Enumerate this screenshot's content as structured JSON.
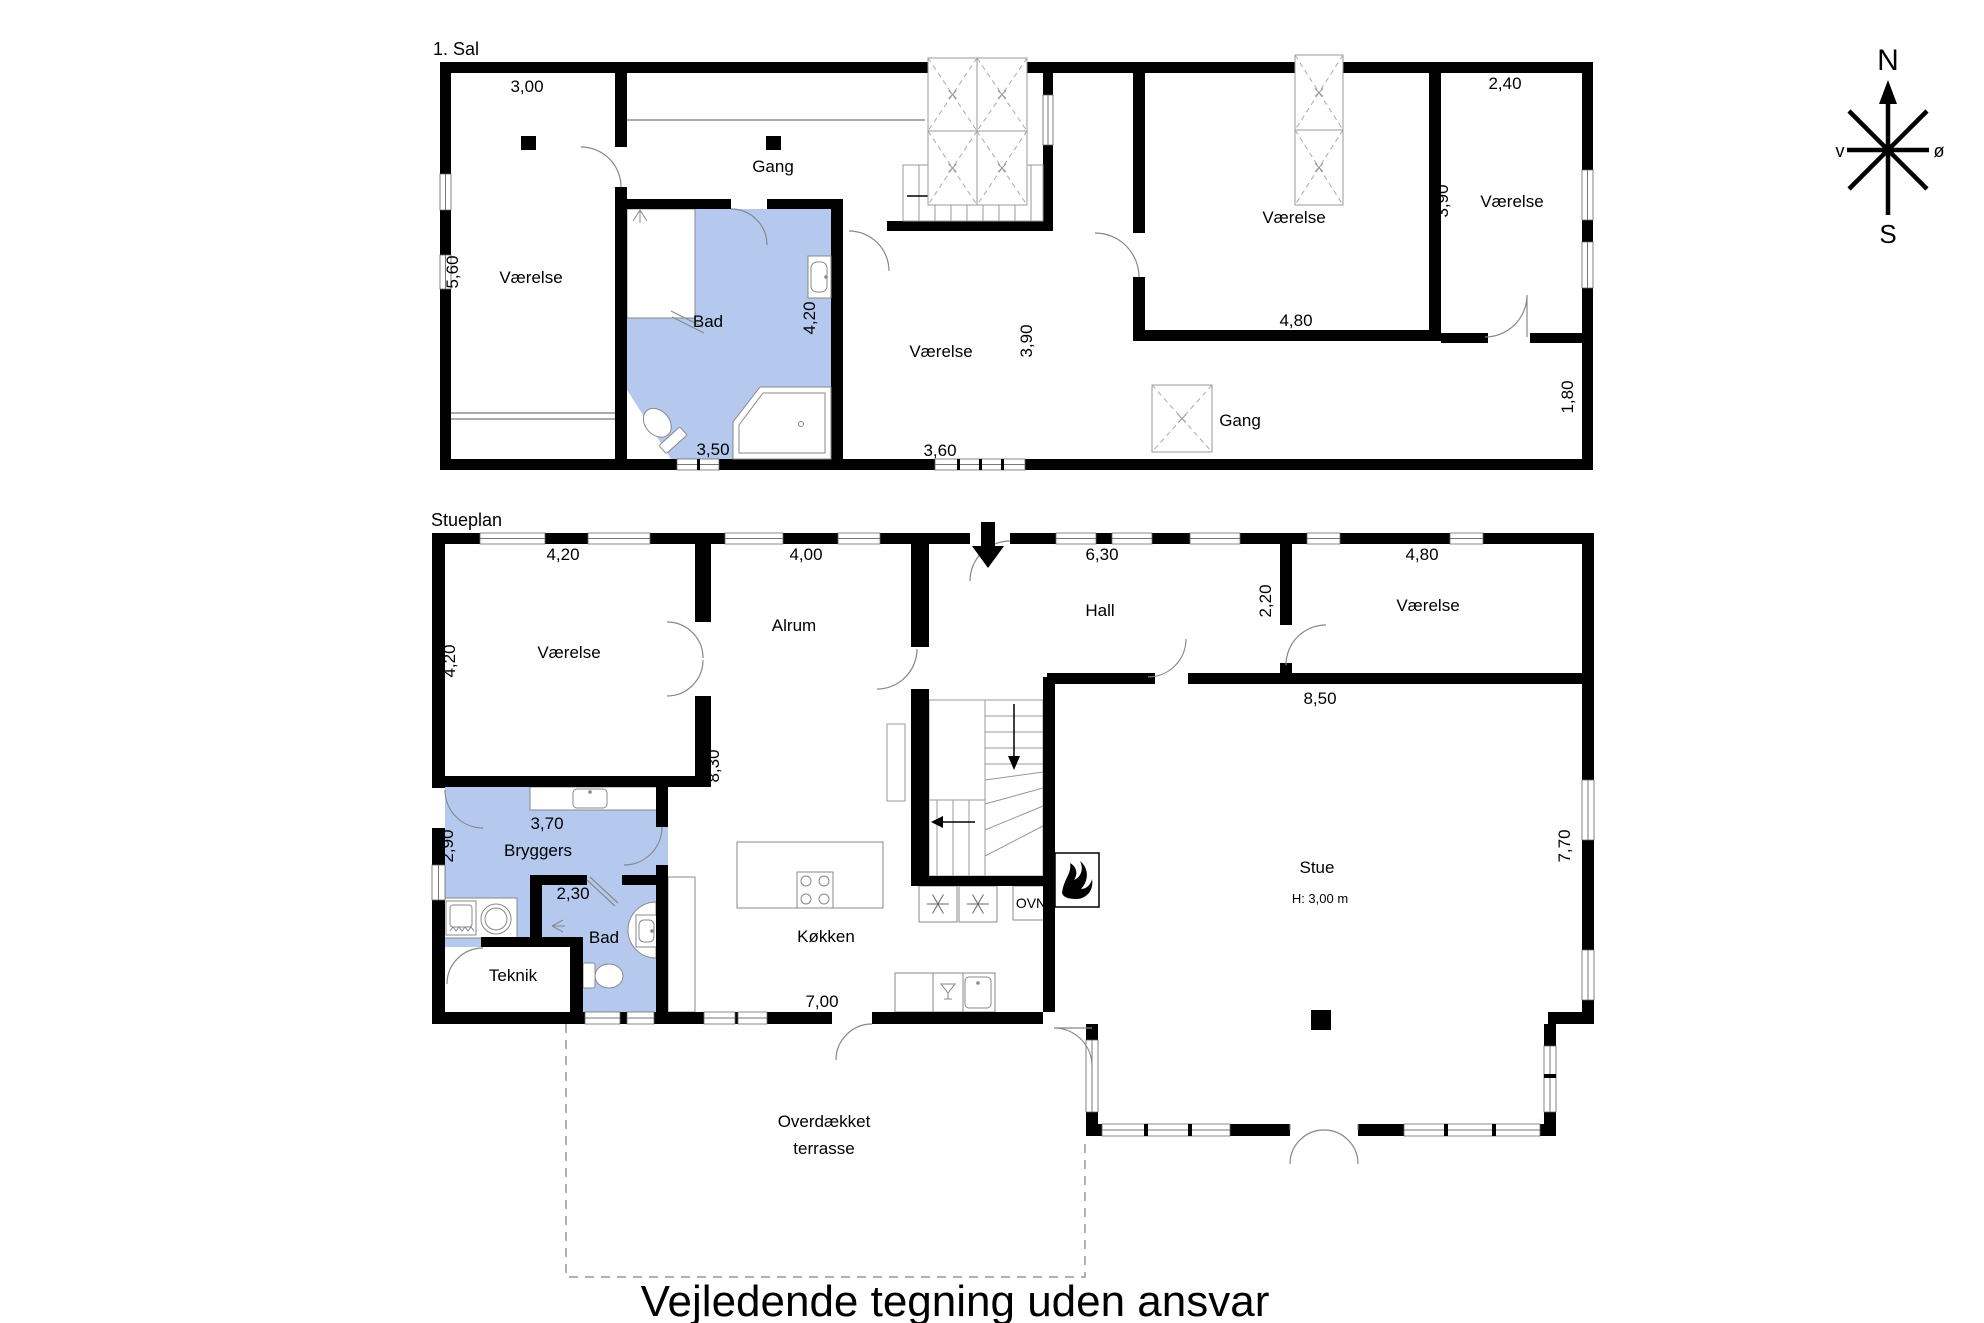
{
  "footer": {
    "text": "Vejledende tegning uden ansvar"
  },
  "compass": {
    "north": "N",
    "south": "S",
    "west": "v",
    "east": "ø"
  },
  "colors": {
    "room_fill": "#b5c9ef",
    "wall": "#000000",
    "fixture_line": "#888888"
  },
  "first_floor": {
    "title": "1. Sal",
    "labels": {
      "room1": "Værelse",
      "gang1": "Gang",
      "bad": "Bad",
      "room2": "Værelse",
      "room3": "Værelse",
      "room4": "Værelse",
      "gang2": "Gang"
    },
    "dims": {
      "d300": "3,00",
      "d560": "5,60",
      "d420": "4,20",
      "d350": "3,50",
      "d360": "3,60",
      "d390a": "3,90",
      "d480": "4,80",
      "d240": "2,40",
      "d390b": "3,90",
      "d180": "1,80"
    }
  },
  "ground_floor": {
    "title": "Stueplan",
    "labels": {
      "room1": "Værelse",
      "alrum": "Alrum",
      "hall": "Hall",
      "room2": "Værelse",
      "bryggers": "Bryggers",
      "bad": "Bad",
      "teknik": "Teknik",
      "koekken": "Køkken",
      "ovn": "OVN",
      "stue": "Stue",
      "stue_height": "H: 3,00 m",
      "terrace_line1": "Overdækket",
      "terrace_line2": "terrasse"
    },
    "dims": {
      "d420a": "4,20",
      "d420b": "4,20",
      "d400": "4,00",
      "d630": "6,30",
      "d480": "4,80",
      "d220": "2,20",
      "d850": "8,50",
      "d830": "8,30",
      "d370": "3,70",
      "d290": "2,90",
      "d230": "2,30",
      "d700": "7,00",
      "d770": "7,70"
    }
  }
}
